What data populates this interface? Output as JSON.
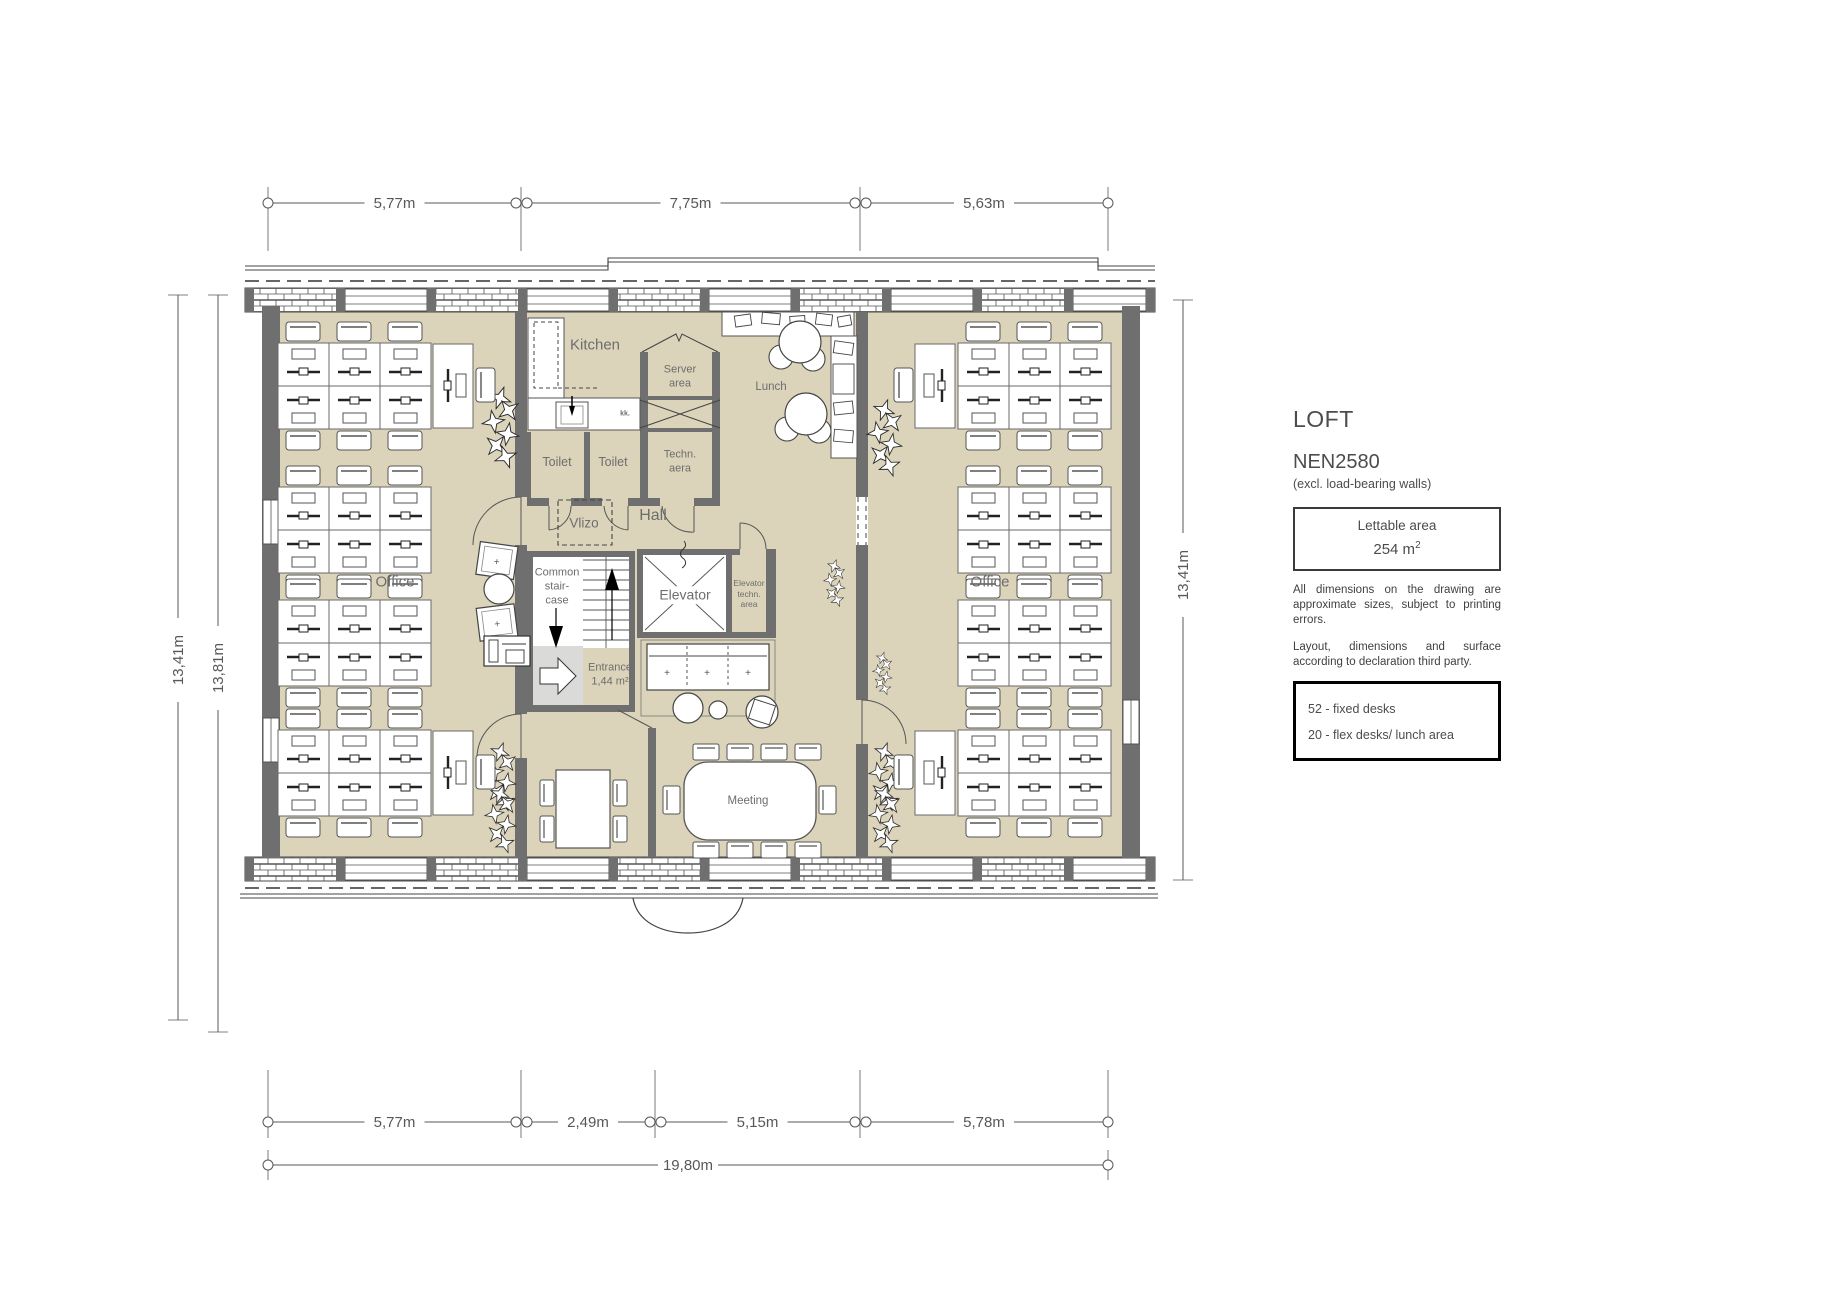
{
  "legend": {
    "title": "LOFT",
    "subtitle": "NEN2580",
    "note": "(excl. load-bearing walls)",
    "lettable_label": "Lettable area",
    "lettable_value": "254 m",
    "lettable_sup": "2",
    "disclaimer1": "All dimensions on the drawing are approximate sizes, subject to printing errors.",
    "disclaimer2": "Layout, dimensions and surface according to declaration third party.",
    "desk_line1": "52 - fixed desks",
    "desk_line2": "20 - flex desks/ lunch area"
  },
  "dimensions": {
    "top": [
      "5,77m",
      "7,75m",
      "5,63m"
    ],
    "bottom": [
      "5,77m",
      "2,49m",
      "5,15m",
      "5,78m"
    ],
    "overall": "19,80m",
    "left_outer": "13,41m",
    "left_inner": "13,81m",
    "right": "13,41m"
  },
  "rooms": {
    "kitchen": {
      "label": "Kitchen",
      "x": 595,
      "y": 346,
      "fs": 15
    },
    "server": {
      "label": "Server\narea",
      "x": 680,
      "y": 377,
      "fs": 11
    },
    "kk": {
      "label": "kk.",
      "x": 625,
      "y": 415,
      "fs": 7,
      "bold": true
    },
    "toilet1": {
      "label": "Toilet",
      "x": 557,
      "y": 463,
      "fs": 12.5
    },
    "toilet2": {
      "label": "Toilet",
      "x": 613,
      "y": 463,
      "fs": 12.5
    },
    "techn": {
      "label": "Techn.\naera",
      "x": 680,
      "y": 462,
      "fs": 11
    },
    "lunch": {
      "label": "Lunch",
      "x": 771,
      "y": 387,
      "fs": 11.5
    },
    "vlizo": {
      "label": "Vlizo",
      "x": 584,
      "y": 524,
      "fs": 13.5
    },
    "hall": {
      "label": "Hall",
      "x": 653,
      "y": 516,
      "fs": 16
    },
    "staircase": {
      "label": "Common\nstair-\ncase",
      "x": 557,
      "y": 587,
      "fs": 11
    },
    "elevator": {
      "label": "Elevator",
      "x": 685,
      "y": 595,
      "fs": 14
    },
    "elevator_techn": {
      "label": "Elevator\ntechn.\narea",
      "x": 749,
      "y": 594,
      "fs": 8.5
    },
    "entrance": {
      "label": "Entrance\n1,44 m²",
      "x": 610,
      "y": 675,
      "fs": 11
    },
    "office_left": {
      "label": "Office",
      "x": 395,
      "y": 583,
      "fs": 15
    },
    "office_right": {
      "label": "Office",
      "x": 990,
      "y": 583,
      "fs": 15
    },
    "meeting": {
      "label": "Meeting",
      "x": 748,
      "y": 801,
      "fs": 11.5
    }
  },
  "colors": {
    "floor": "#dbd4ba",
    "wall": "#6f6f6f",
    "line": "#58585a",
    "label_text": "#6d6d6d"
  }
}
